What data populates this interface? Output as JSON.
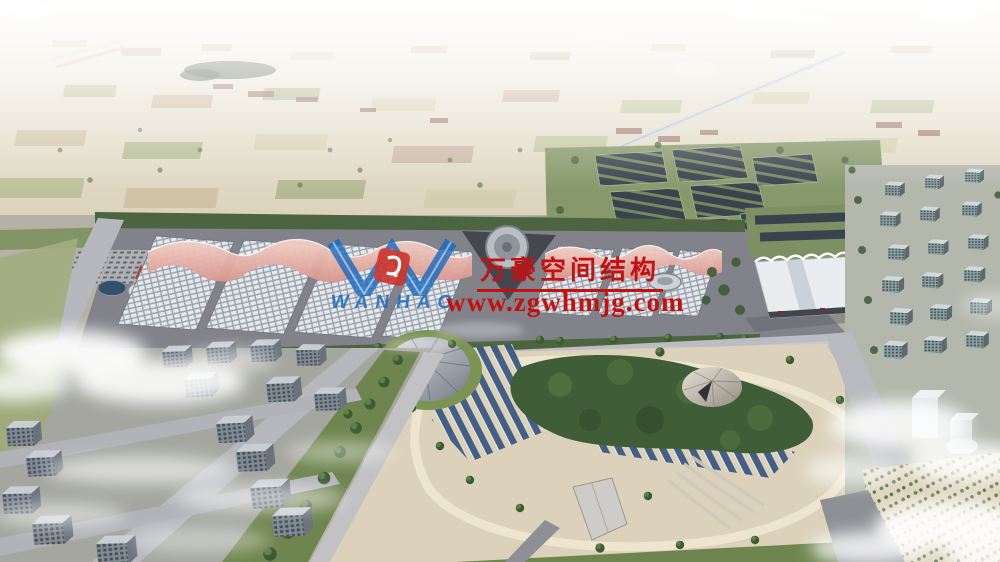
{
  "watermark": {
    "logo_icon": "wanhao-w-monogram-icon",
    "logo_text": "WANHAO",
    "company_name": "万豪空间结构",
    "website": "www.zgwhmjg.com"
  },
  "palette": {
    "wm_red": "#c31111",
    "wm_blue": "#1a6abf",
    "wm_emblem_red": "#d03028",
    "membrane_pink": "#e2a395",
    "hall_grid": "#e5e8ec",
    "park_ground": "#dcd2bb",
    "road_grey": "#b9bac0",
    "plaza_grey": "#81828a",
    "grass_green": "#7d9160",
    "tree_green": "#3e5c35",
    "solar_navy": "#39434e",
    "park_panel_blue": "#3a5a84",
    "haze_white": "#ffffff"
  }
}
